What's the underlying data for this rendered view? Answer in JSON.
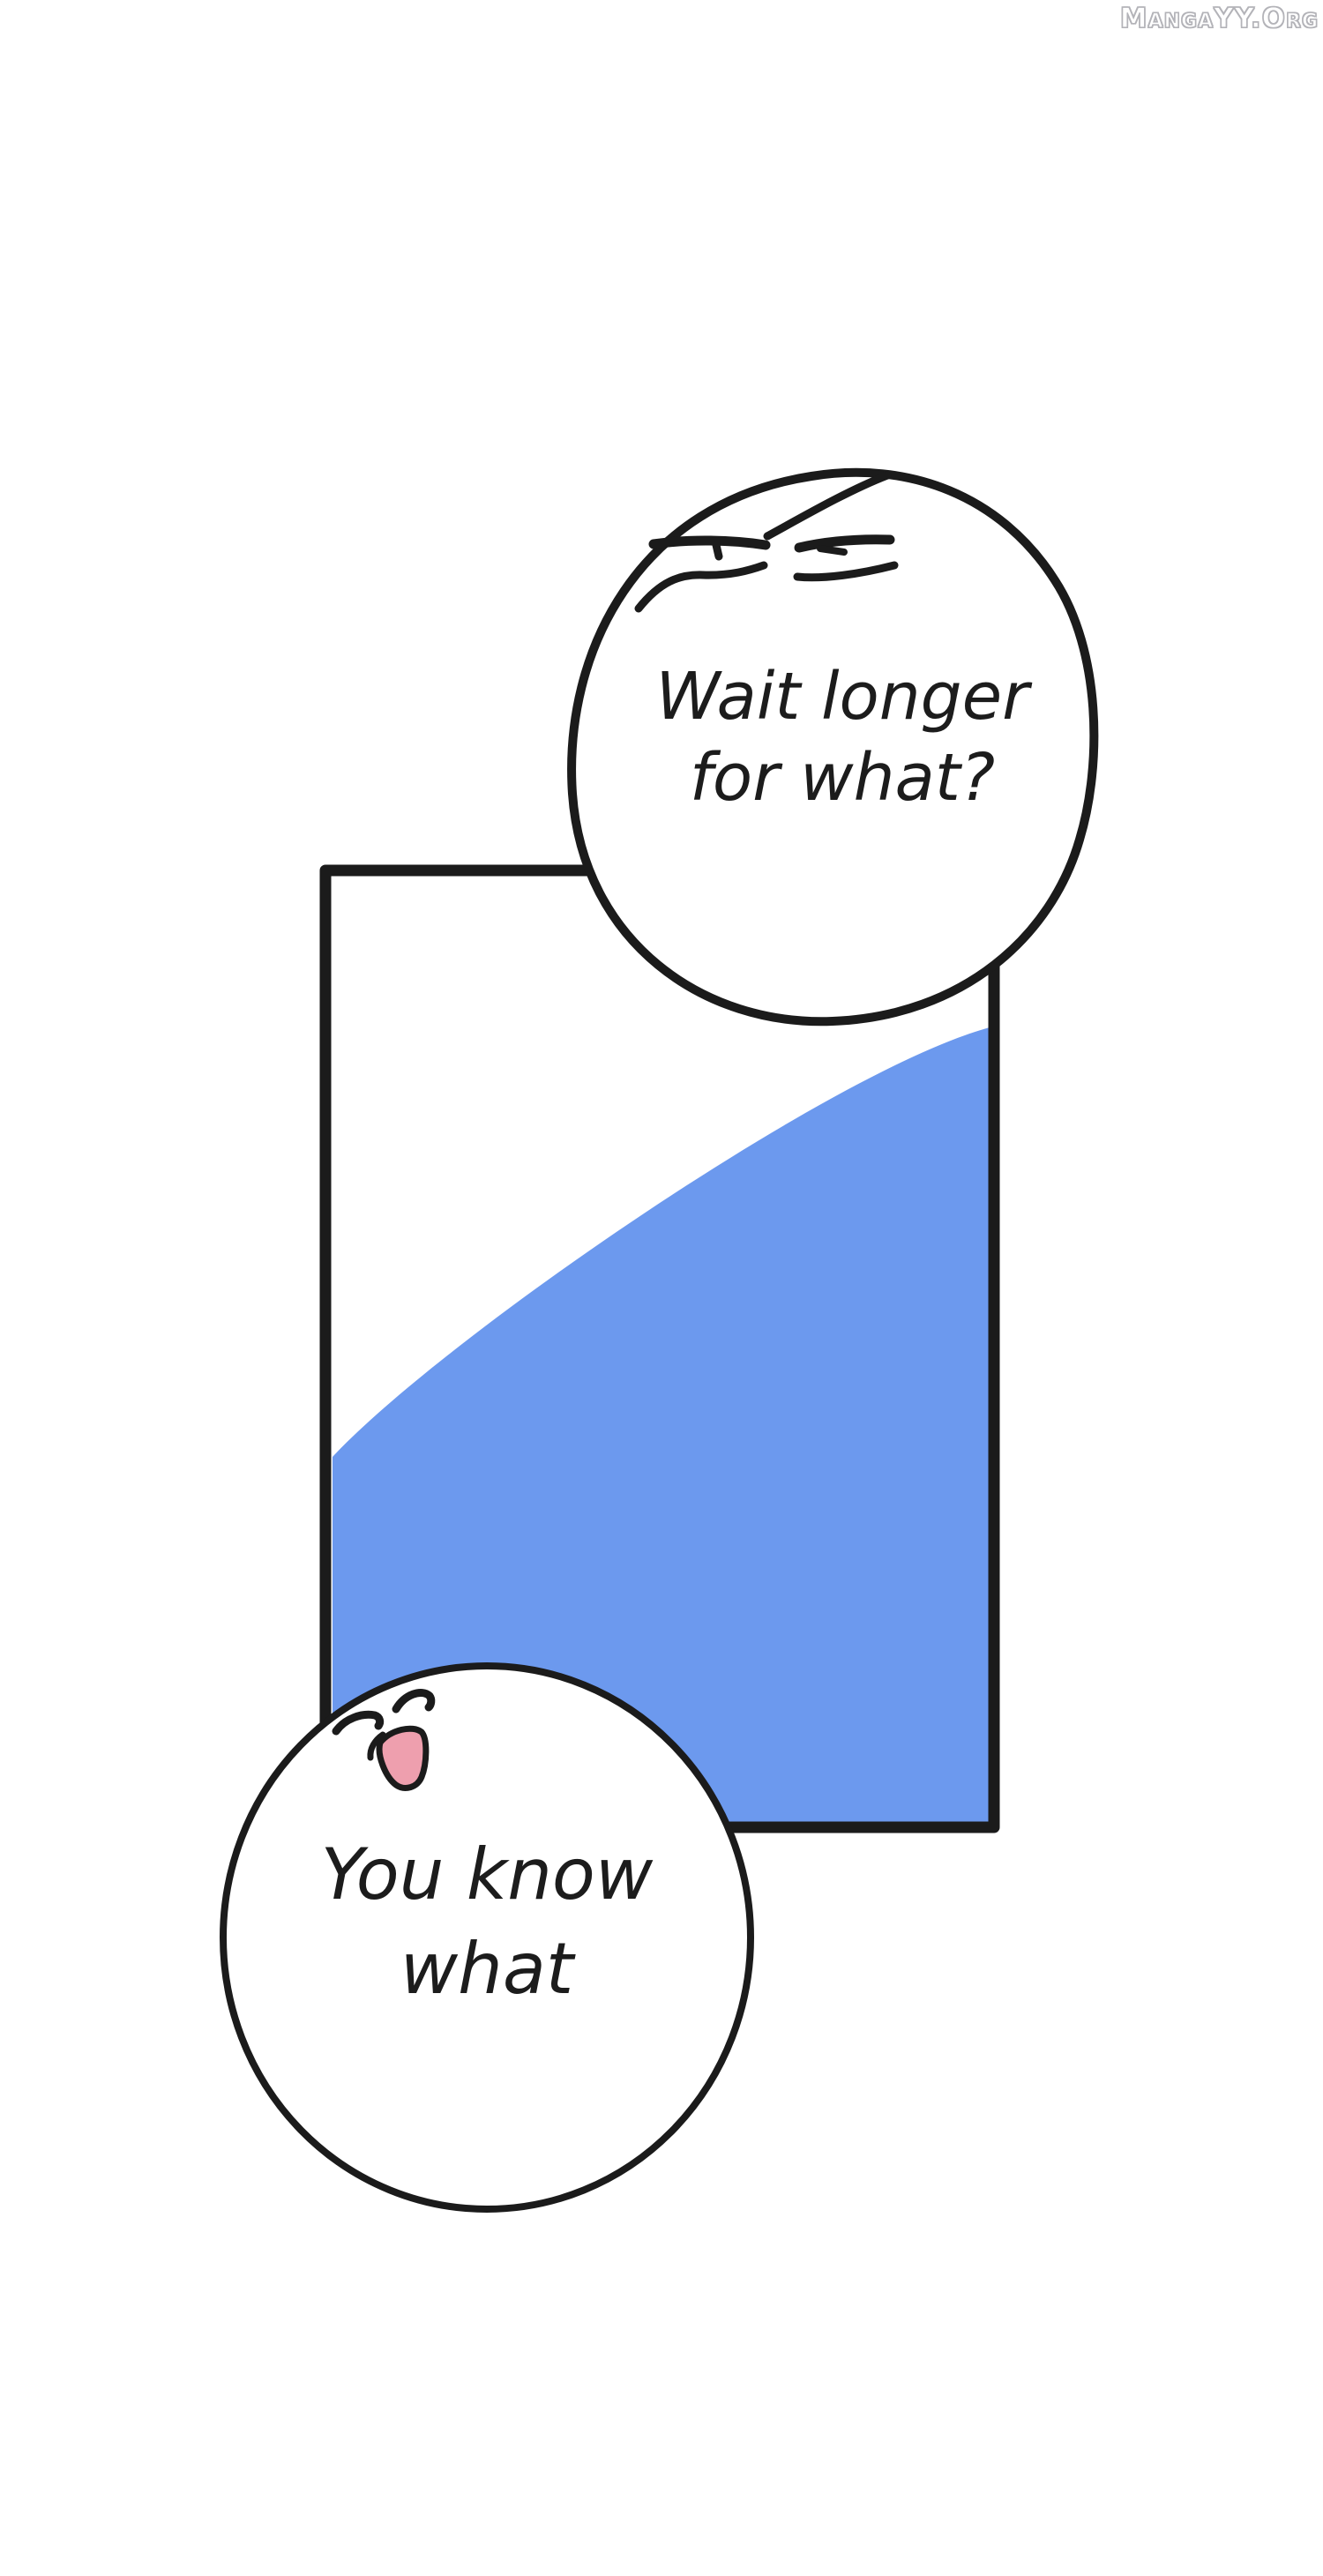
{
  "watermark": {
    "text": "MangaYY.Org"
  },
  "speech_bubbles": {
    "top": {
      "character": "squinting-skeptical-face",
      "lines": [
        "Wait longer",
        "for what?"
      ]
    },
    "bottom": {
      "character": "closed-eyes-open-mouth-face",
      "lines": [
        "You know",
        "what"
      ]
    }
  },
  "colors": {
    "ink": "#1b1b1b",
    "text_ink": "#1c1c1c",
    "panel_fill_blue": "#6C99EE",
    "bubble_fill": "#ffffff",
    "mouth_pink": "#EE9FAE",
    "watermark_outline": "#b3b3b8"
  }
}
